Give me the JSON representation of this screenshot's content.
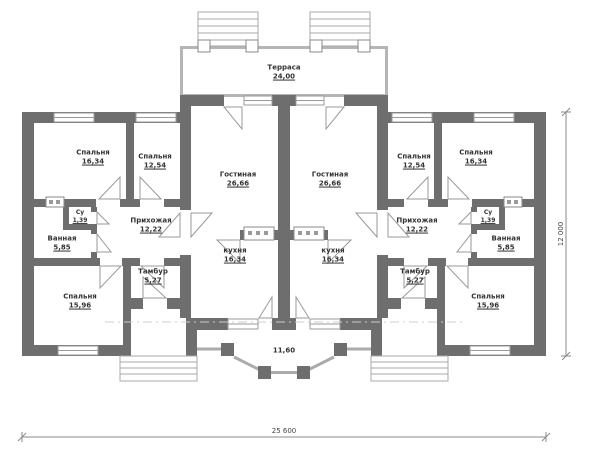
{
  "colors": {
    "wall": "#6e6e6e",
    "light": "#b5b5b5",
    "frame": "#9a9a9a",
    "dim": "#8a8a8a",
    "axis": "#cccccc",
    "text": "#333333"
  },
  "plan": {
    "terrace": {
      "name": "Терраса",
      "area": "24,00"
    },
    "porch": {
      "width": "11,60"
    },
    "dimensions": {
      "width": "25 600",
      "depth": "12 000"
    },
    "left_unit": {
      "rooms": [
        {
          "name": "Спальня",
          "area": "16,34"
        },
        {
          "name": "Спальня",
          "area": "12,54"
        },
        {
          "name": "Гостиная",
          "area": "26,66"
        },
        {
          "name": "Су",
          "area": "1,39"
        },
        {
          "name": "Ванная",
          "area": "5,85"
        },
        {
          "name": "Прихожая",
          "area": "12,22"
        },
        {
          "name": "кухня",
          "area": "16,34"
        },
        {
          "name": "Тамбур",
          "area": "5,27"
        },
        {
          "name": "Спальня",
          "area": "15,96"
        }
      ]
    },
    "right_unit": {
      "rooms": [
        {
          "name": "Спальня",
          "area": "16,34"
        },
        {
          "name": "Спальня",
          "area": "12,54"
        },
        {
          "name": "Гостиная",
          "area": "26,66"
        },
        {
          "name": "Су",
          "area": "1,39"
        },
        {
          "name": "Ванная",
          "area": "5,85"
        },
        {
          "name": "Прихожая",
          "area": "12,22"
        },
        {
          "name": "кухня",
          "area": "16,34"
        },
        {
          "name": "Тамбур",
          "area": "5,27"
        },
        {
          "name": "Спальня",
          "area": "15,96"
        }
      ]
    }
  }
}
